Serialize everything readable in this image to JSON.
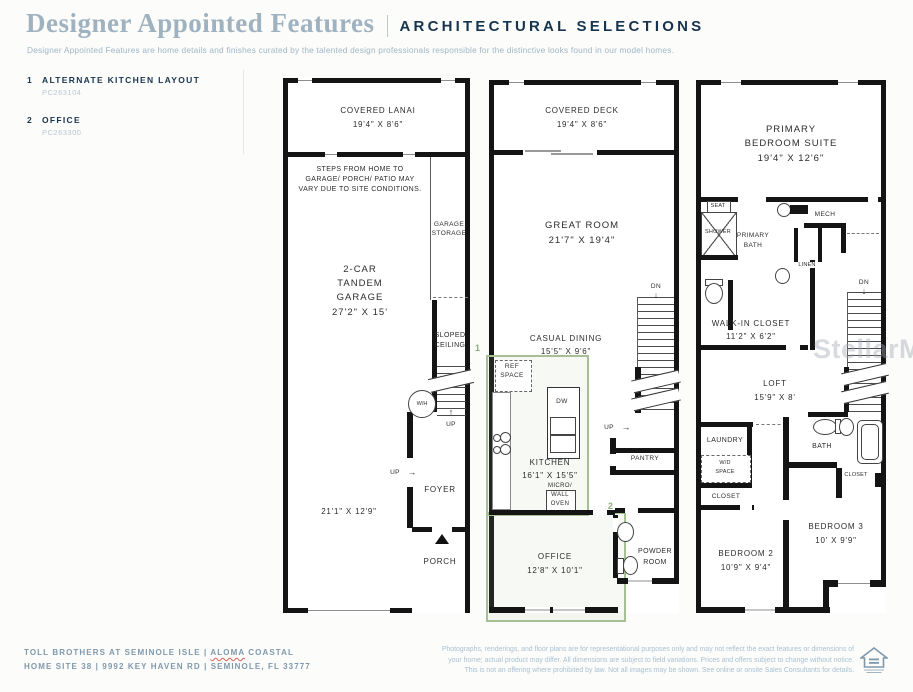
{
  "header": {
    "title": "Designer Appointed Features",
    "tagline": "ARCHITECTURAL SELECTIONS",
    "description": "Designer Appointed Features are home details and finishes curated by the talented design professionals responsible for the distinctive looks found in our model homes."
  },
  "legend": {
    "items": [
      {
        "num": "1",
        "label": "ALTERNATE KITCHEN LAYOUT",
        "code": "PC263104"
      },
      {
        "num": "2",
        "label": "OFFICE",
        "code": "PC263300"
      }
    ]
  },
  "icons": {
    "up_arrow": "↑",
    "down_arrow": "↓",
    "right_arrow": "→"
  },
  "floor1": {
    "lanai_name": "COVERED LANAI",
    "lanai_dim": "19'4\" X 8'6\"",
    "steps_note_1": "STEPS FROM HOME TO",
    "steps_note_2": "GARAGE/ PORCH/ PATIO MAY",
    "steps_note_3": "VARY DUE TO SITE CONDITIONS.",
    "garage_storage_1": "GARAGE",
    "garage_storage_2": "STORAGE",
    "garage_1": "2-CAR",
    "garage_2": "TANDEM",
    "garage_3": "GARAGE",
    "garage_dim": "27'2\" X 15'",
    "sloped_1": "SLOPED",
    "sloped_2": "CEILING",
    "wh": "W/H",
    "up_stairs": "UP",
    "up_foyer": "UP",
    "foyer": "FOYER",
    "garage_dim2": "21'1\" X 12'9\"",
    "porch": "PORCH"
  },
  "floor2": {
    "deck_name": "COVERED DECK",
    "deck_dim": "19'4\" X 8'6\"",
    "great_room": "GREAT ROOM",
    "great_room_dim": "21'7\" X 19'4\"",
    "dn": "DN",
    "casual_dining": "CASUAL DINING",
    "casual_dining_dim": "15'5\" X 9'6\"",
    "marker1": "1",
    "ref_1": "REF",
    "ref_2": "SPACE",
    "dw": "DW",
    "kitchen": "KITCHEN",
    "kitchen_dim": "16'1\" X 15'5\"",
    "micro": "MICRO/",
    "wall_oven_1": "WALL",
    "wall_oven_2": "OVEN",
    "up": "UP",
    "pantry": "PANTRY",
    "marker2": "2",
    "office": "OFFICE",
    "office_dim": "12'8\" X 10'1\"",
    "powder_1": "POWDER",
    "powder_2": "ROOM"
  },
  "floor3": {
    "suite_1": "PRIMARY",
    "suite_2": "BEDROOM SUITE",
    "suite_dim": "19'4\" X 12'6\"",
    "seat": "SEAT",
    "shower": "SHOWER",
    "pbath_1": "PRIMARY",
    "pbath_2": "BATH",
    "mech": "MECH",
    "linen": "LINEN",
    "wic": "WALK-IN CLOSET",
    "wic_dim": "11'2\" X 6'2\"",
    "dn": "DN",
    "loft": "LOFT",
    "loft_dim": "15'9\" X 8'",
    "laundry": "LAUNDRY",
    "wd_1": "W/D",
    "wd_2": "SPACE",
    "closet_left": "CLOSET",
    "bath": "BATH",
    "closet_right": "CLOSET",
    "bed3": "BEDROOM 3",
    "bed3_dim": "10' X 9'9\"",
    "bed2": "BEDROOM 2",
    "bed2_dim": "10'9\" X 9'4\""
  },
  "watermark": "StellarMLS",
  "footer": {
    "line1_pre": "TOLL BROTHERS AT SEMINOLE ISLE | ",
    "line1_highlight": "ALOMA",
    "line1_post": " COASTAL",
    "line2": "HOME SITE 38  |  9992 KEY HAVEN RD  |  SEMINOLE, FL 33777",
    "disclaimer_1": "Photographs, renderings, and floor plans are for representational purposes only and may not reflect the exact features or dimensions of",
    "disclaimer_2": "your home; actual product may differ. All dimensions are subject to field variations. Prices and offers subject to change without notice.",
    "disclaimer_3": "This is not an offering where prohibited by law. Not all images may be shown. See online or onsite Sales Consultants for details."
  },
  "colors": {
    "accent_green": "#a5c194",
    "navy": "#17344f",
    "footer_blue": "#7f99ac",
    "disclaimer_blue": "#a9c2d4"
  }
}
